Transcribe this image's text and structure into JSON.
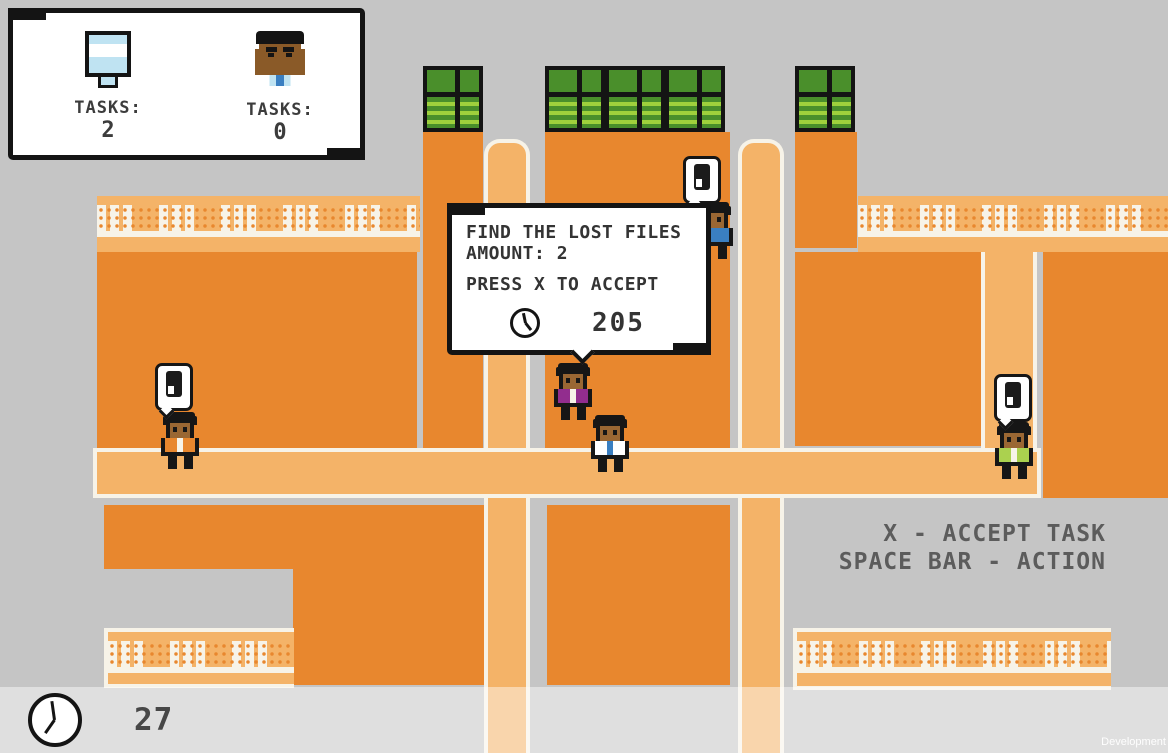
{
  "tasks_panel": {
    "board": {
      "icon": "whiteboard-icon",
      "label": "TASKS:",
      "value": "2"
    },
    "person": {
      "icon": "person-icon",
      "label": "TASKS:",
      "value": "0"
    }
  },
  "task_dialog": {
    "title": "FIND THE LOST FILES",
    "amount_line": "AMOUNT: 2",
    "accept_line": "PRESS X TO ACCEPT",
    "clock_icon": "clock-icon",
    "timer": "205"
  },
  "instructions": {
    "line1": "X - ACCEPT TASK",
    "line2": "SPACE BAR - ACTION"
  },
  "hud": {
    "clock_icon": "clock-icon",
    "timer": "27"
  },
  "watermark": "Development",
  "npcs": [
    {
      "id": "npc-orange-shirt",
      "shirt_color": "#e8872e",
      "speech_bubble": true
    },
    {
      "id": "npc-purple-jacket",
      "shirt_color": "#922d8e",
      "speech_bubble": false
    },
    {
      "id": "npc-white-shirt-blue-tie",
      "shirt_color": "#ffffff",
      "speech_bubble": false
    },
    {
      "id": "npc-green-shirt",
      "shirt_color": "#abd14f",
      "speech_bubble": true
    },
    {
      "id": "npc-blue-shirt",
      "shirt_color": "#3a7fc1",
      "speech_bubble": true
    }
  ],
  "colors": {
    "background_gray": "#c5c5c5",
    "floor_orange": "#e8872e",
    "walkway_orange": "#f4b368",
    "outline_white": "#f7f3e8",
    "cabinet_green": "#4a8f2b",
    "cabinet_stripe_green": "#9fd03c",
    "panel_border_black": "#141414",
    "text_dark": "#343434",
    "instruction_gray": "#5c5c5c"
  }
}
